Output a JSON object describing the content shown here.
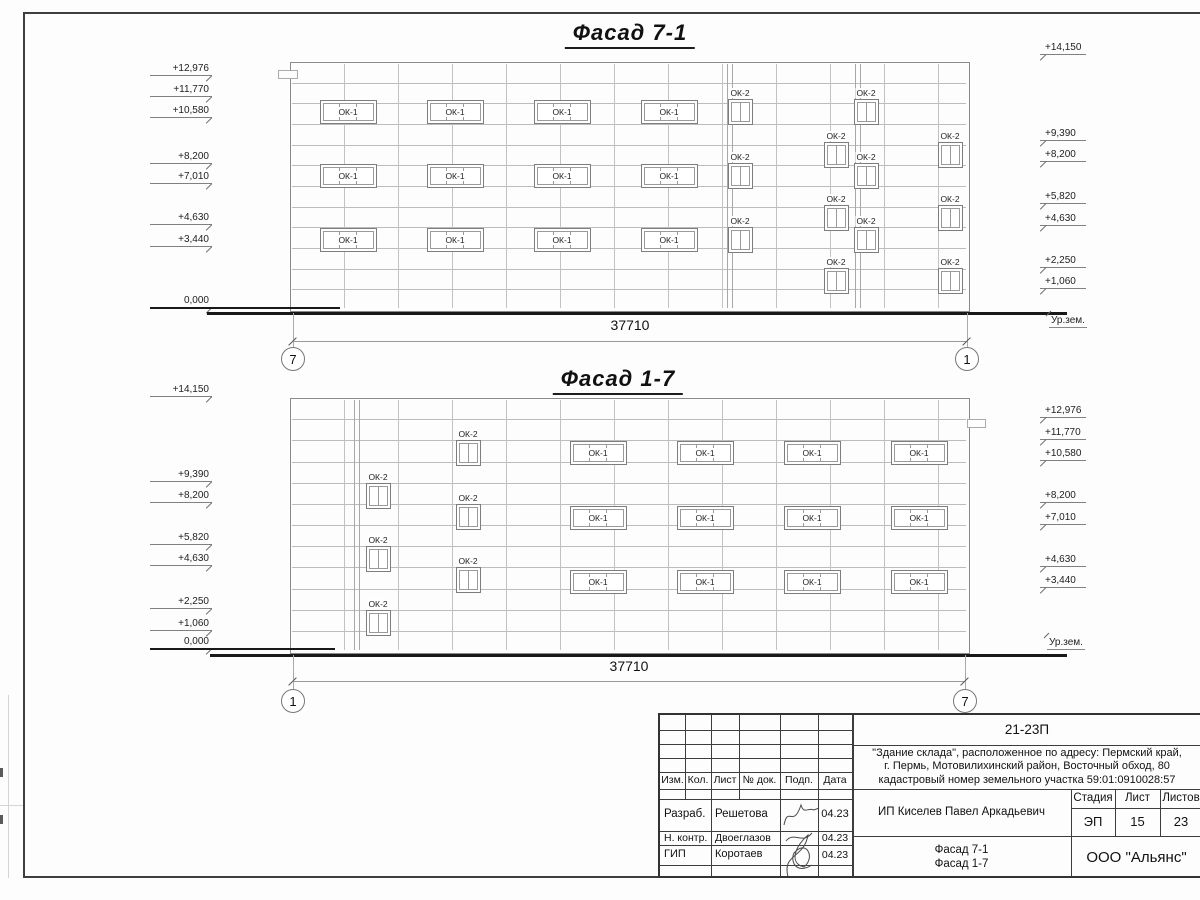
{
  "sheet": {
    "kind": "architectural elevation drawing"
  },
  "facades": [
    {
      "title": "Фасад 7-1",
      "building": {
        "x": 290,
        "y": 62,
        "w": 678,
        "h": 248
      },
      "double_lines_x": [
        727,
        855
      ],
      "marks_left_x": 150,
      "marks_right_x": 1040,
      "marks_left": [
        {
          "label": "+12,976",
          "y": 62
        },
        {
          "label": "+11,770",
          "y": 83
        },
        {
          "label": "+10,580",
          "y": 104
        },
        {
          "label": "+8,200",
          "y": 150
        },
        {
          "label": "+7,010",
          "y": 170
        },
        {
          "label": "+4,630",
          "y": 211
        },
        {
          "label": "+3,440",
          "y": 233
        },
        {
          "label": "0,000",
          "y": 294
        }
      ],
      "marks_right": [
        {
          "label": "+14,150",
          "y": 41
        },
        {
          "label": "+9,390",
          "y": 127
        },
        {
          "label": "+8,200",
          "y": 148
        },
        {
          "label": "+5,820",
          "y": 190
        },
        {
          "label": "+4,630",
          "y": 212
        },
        {
          "label": "+2,250",
          "y": 254
        },
        {
          "label": "+1,060",
          "y": 275
        }
      ],
      "windows": [
        {
          "t": "ОК-1",
          "x": 348,
          "y": 112
        },
        {
          "t": "ОК-1",
          "x": 455,
          "y": 112
        },
        {
          "t": "ОК-1",
          "x": 562,
          "y": 112
        },
        {
          "t": "ОК-1",
          "x": 669,
          "y": 112
        },
        {
          "t": "ОК-1",
          "x": 348,
          "y": 176
        },
        {
          "t": "ОК-1",
          "x": 455,
          "y": 176
        },
        {
          "t": "ОК-1",
          "x": 562,
          "y": 176
        },
        {
          "t": "ОК-1",
          "x": 669,
          "y": 176
        },
        {
          "t": "ОК-1",
          "x": 348,
          "y": 240
        },
        {
          "t": "ОК-1",
          "x": 455,
          "y": 240
        },
        {
          "t": "ОК-1",
          "x": 562,
          "y": 240
        },
        {
          "t": "ОК-1",
          "x": 669,
          "y": 240
        },
        {
          "t": "ОК-2",
          "x": 740,
          "y": 112
        },
        {
          "t": "ОК-2",
          "x": 866,
          "y": 112
        },
        {
          "t": "ОК-2",
          "x": 740,
          "y": 176
        },
        {
          "t": "ОК-2",
          "x": 866,
          "y": 176
        },
        {
          "t": "ОК-2",
          "x": 740,
          "y": 240
        },
        {
          "t": "ОК-2",
          "x": 866,
          "y": 240
        },
        {
          "t": "ОК-2",
          "x": 836,
          "y": 155
        },
        {
          "t": "ОК-2",
          "x": 950,
          "y": 155
        },
        {
          "t": "ОК-2",
          "x": 836,
          "y": 218
        },
        {
          "t": "ОК-2",
          "x": 950,
          "y": 218
        },
        {
          "t": "ОК-2",
          "x": 836,
          "y": 281
        },
        {
          "t": "ОК-2",
          "x": 950,
          "y": 281
        }
      ],
      "ground": [
        {
          "x1": 207,
          "x2": 1067,
          "y": 312,
          "t": 3
        },
        {
          "x1": 150,
          "x2": 340,
          "y": 307,
          "t": 2
        }
      ],
      "dim": {
        "x1": 293,
        "x2": 967,
        "y": 341,
        "label": "37710",
        "label_y": 317
      },
      "axis_y": 359,
      "axes": [
        {
          "label": "7",
          "x": 293
        },
        {
          "label": "1",
          "x": 967
        }
      ],
      "ground_label": {
        "text": "Ур.зем.",
        "x": 1049,
        "y": 315
      },
      "details": [
        {
          "x": 278,
          "y": 70,
          "w": 18,
          "h": 7
        }
      ]
    },
    {
      "title": "Фасад 1-7",
      "building": {
        "x": 290,
        "y": 398,
        "w": 678,
        "h": 254
      },
      "double_lines_x": [
        354
      ],
      "marks_left_x": 150,
      "marks_right_x": 1040,
      "marks_left": [
        {
          "label": "+14,150",
          "y": 383
        },
        {
          "label": "+9,390",
          "y": 468
        },
        {
          "label": "+8,200",
          "y": 489
        },
        {
          "label": "+5,820",
          "y": 531
        },
        {
          "label": "+4,630",
          "y": 552
        },
        {
          "label": "+2,250",
          "y": 595
        },
        {
          "label": "+1,060",
          "y": 617
        },
        {
          "label": "0,000",
          "y": 635
        }
      ],
      "marks_right": [
        {
          "label": "+12,976",
          "y": 404
        },
        {
          "label": "+11,770",
          "y": 426
        },
        {
          "label": "+10,580",
          "y": 447
        },
        {
          "label": "+8,200",
          "y": 489
        },
        {
          "label": "+7,010",
          "y": 511
        },
        {
          "label": "+4,630",
          "y": 553
        },
        {
          "label": "+3,440",
          "y": 574
        }
      ],
      "windows": [
        {
          "t": "ОК-1",
          "x": 598,
          "y": 453
        },
        {
          "t": "ОК-1",
          "x": 705,
          "y": 453
        },
        {
          "t": "ОК-1",
          "x": 812,
          "y": 453
        },
        {
          "t": "ОК-1",
          "x": 919,
          "y": 453
        },
        {
          "t": "ОК-1",
          "x": 598,
          "y": 518
        },
        {
          "t": "ОК-1",
          "x": 705,
          "y": 518
        },
        {
          "t": "ОК-1",
          "x": 812,
          "y": 518
        },
        {
          "t": "ОК-1",
          "x": 919,
          "y": 518
        },
        {
          "t": "ОК-1",
          "x": 598,
          "y": 582
        },
        {
          "t": "ОК-1",
          "x": 705,
          "y": 582
        },
        {
          "t": "ОК-1",
          "x": 812,
          "y": 582
        },
        {
          "t": "ОК-1",
          "x": 919,
          "y": 582
        },
        {
          "t": "ОК-2",
          "x": 468,
          "y": 453
        },
        {
          "t": "ОК-2",
          "x": 468,
          "y": 517
        },
        {
          "t": "ОК-2",
          "x": 468,
          "y": 580
        },
        {
          "t": "ОК-2",
          "x": 378,
          "y": 496
        },
        {
          "t": "ОК-2",
          "x": 378,
          "y": 559
        },
        {
          "t": "ОК-2",
          "x": 378,
          "y": 623
        }
      ],
      "ground": [
        {
          "x1": 210,
          "x2": 1067,
          "y": 654,
          "t": 3
        },
        {
          "x1": 150,
          "x2": 335,
          "y": 648,
          "t": 2
        }
      ],
      "dim": {
        "x1": 293,
        "x2": 965,
        "y": 681,
        "label": "37710",
        "label_y": 658
      },
      "axis_y": 701,
      "axes": [
        {
          "label": "1",
          "x": 293
        },
        {
          "label": "7",
          "x": 965
        }
      ],
      "ground_label": {
        "text": "Ур.зем.",
        "x": 1047,
        "y": 637
      },
      "details": [
        {
          "x": 967,
          "y": 419,
          "w": 17,
          "h": 7
        }
      ]
    }
  ],
  "titleblock": {
    "doc_number": "21-23П",
    "description_lines": [
      "\"Здание склада\", расположенное по адресу: Пермский край,",
      "г. Пермь, Мотовилихинский район, Восточный обход, 80",
      "кадастровый номер земельного участка 59:01:0910028:57"
    ],
    "header_cols": [
      "Изм.",
      "Кол.",
      "Лист",
      "№ док.",
      "Подп.",
      "Дата"
    ],
    "rows": [
      {
        "role": "Разраб.",
        "name": "Решетова",
        "date": "04.23"
      },
      {
        "role": "Н. контр.",
        "name": "Двоеглазов",
        "date": "04.23"
      },
      {
        "role": "ГИП",
        "name": "Коротаев",
        "date": "04.23"
      }
    ],
    "client": "ИП Киселев Павел Аркадьевич",
    "stage_label": "Стадия",
    "sheet_label": "Лист",
    "sheets_label": "Листов",
    "stage": "ЭП",
    "sheet_no": "15",
    "sheets_total": "23",
    "subject_lines": [
      "Фасад 7-1",
      "Фасад 1-7"
    ],
    "company": "ООО \"Альянс\""
  }
}
